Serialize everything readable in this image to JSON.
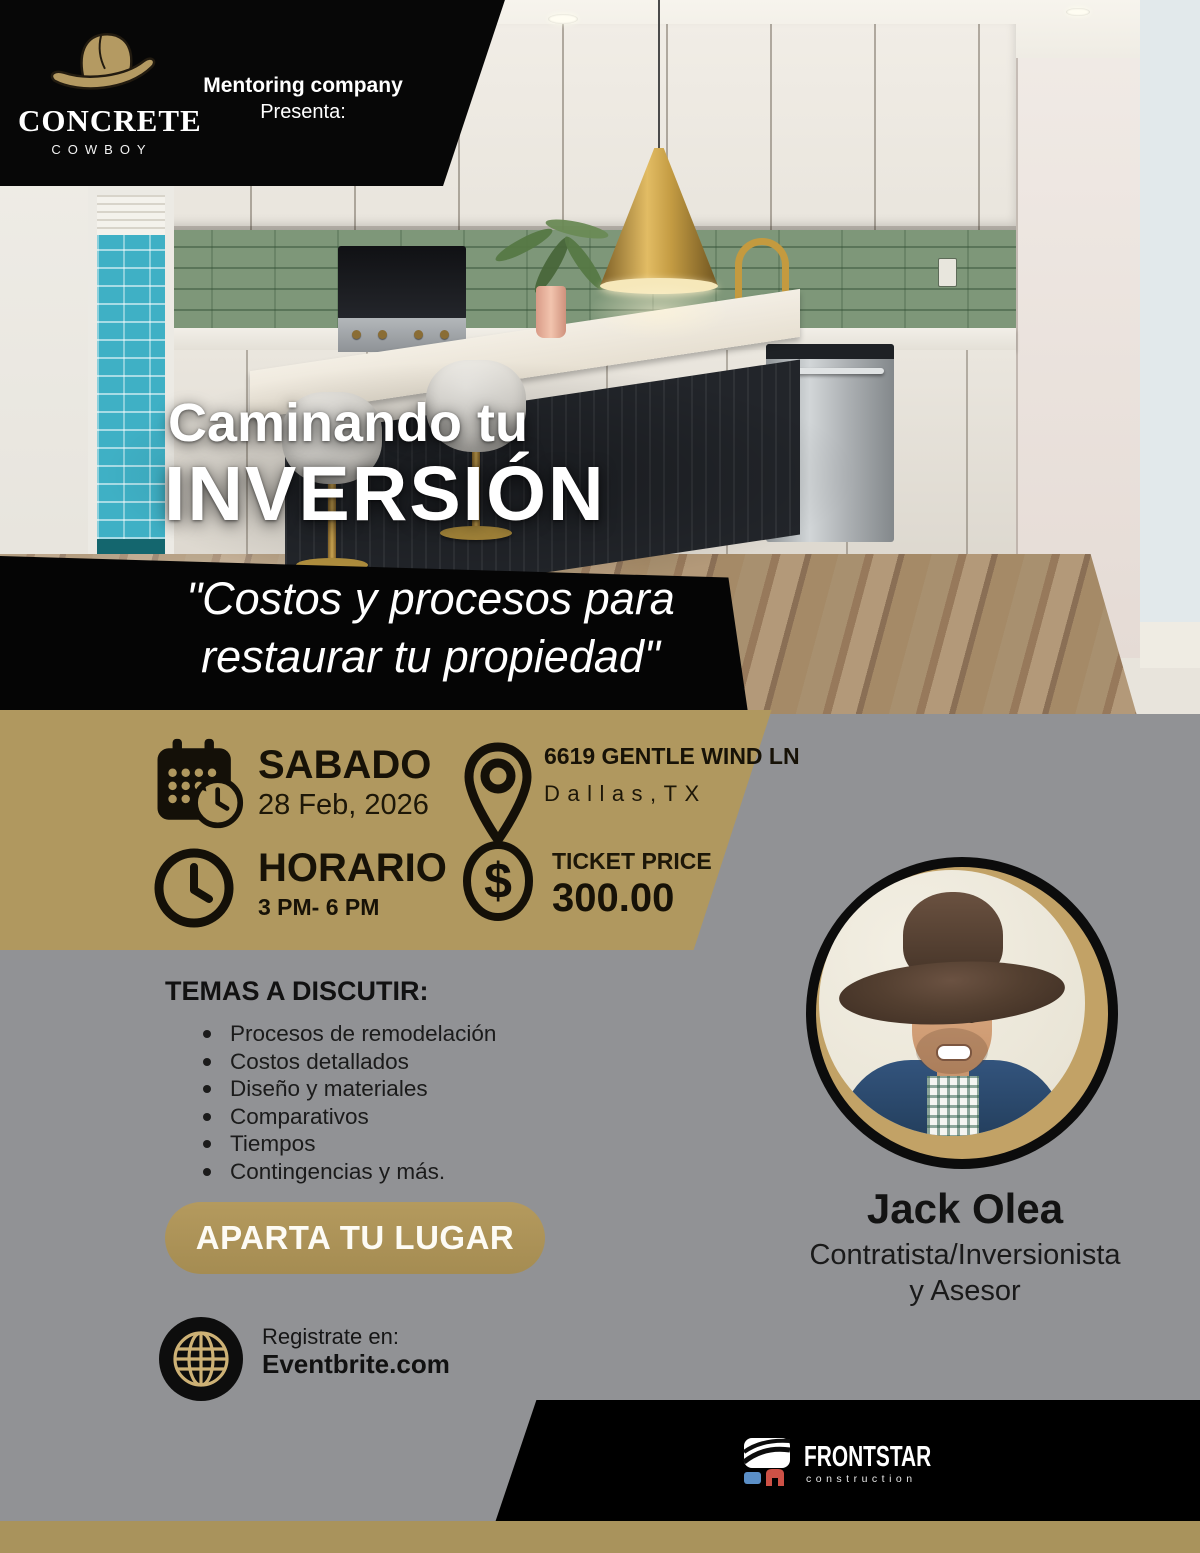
{
  "brand": {
    "name": "CONCRETE",
    "sub": "COWBOY",
    "presenter_line1": "Mentoring company",
    "presenter_line2": "Presenta:"
  },
  "hero": {
    "title_line1": "Caminando tu",
    "title_line2": "INVERSIÓN",
    "quote_line1": "\"Costos y procesos para",
    "quote_line2": "restaurar tu propiedad\""
  },
  "details": {
    "date": {
      "label": "SABADO",
      "value": "28 Feb, 2026"
    },
    "location": {
      "line1": "6619 GENTLE WIND LN",
      "line2": "Dallas,TX"
    },
    "schedule": {
      "label": "HORARIO",
      "value": "3 PM- 6 PM"
    },
    "price": {
      "label": "TICKET PRICE",
      "value": "300.00"
    }
  },
  "topics": {
    "heading": "TEMAS A DISCUTIR:",
    "items": [
      "Procesos de remodelación",
      "Costos detallados",
      "Diseño y materiales",
      "Comparativos",
      "Tiempos",
      "Contingencias y más."
    ]
  },
  "cta": {
    "button_label": "APARTA TU LUGAR",
    "register_label": "Registrate en:",
    "register_site": "Eventbrite.com"
  },
  "speaker": {
    "name": "Jack Olea",
    "role_line1": "Contratista/Inversionista",
    "role_line2": "y Asesor"
  },
  "footer": {
    "logo_text": "FRONTSTAR",
    "logo_sub": "construction"
  },
  "icons": {
    "brand": "cowboy-hat-icon",
    "date": "calendar-clock-icon",
    "location": "location-pin-icon",
    "schedule": "clock-icon",
    "price": "dollar-icon",
    "register": "globe-icon",
    "footer": "frontstar-mark-icon"
  },
  "colors": {
    "tan_band": "#b0985f",
    "gold_strip": "#a9935c",
    "button_gold": "#ab9259",
    "ring_gold": "#c2a266",
    "gray_bg": "#919295",
    "black": "#070707",
    "logo_blue": "#5b8fc7",
    "logo_red": "#cd5146"
  }
}
